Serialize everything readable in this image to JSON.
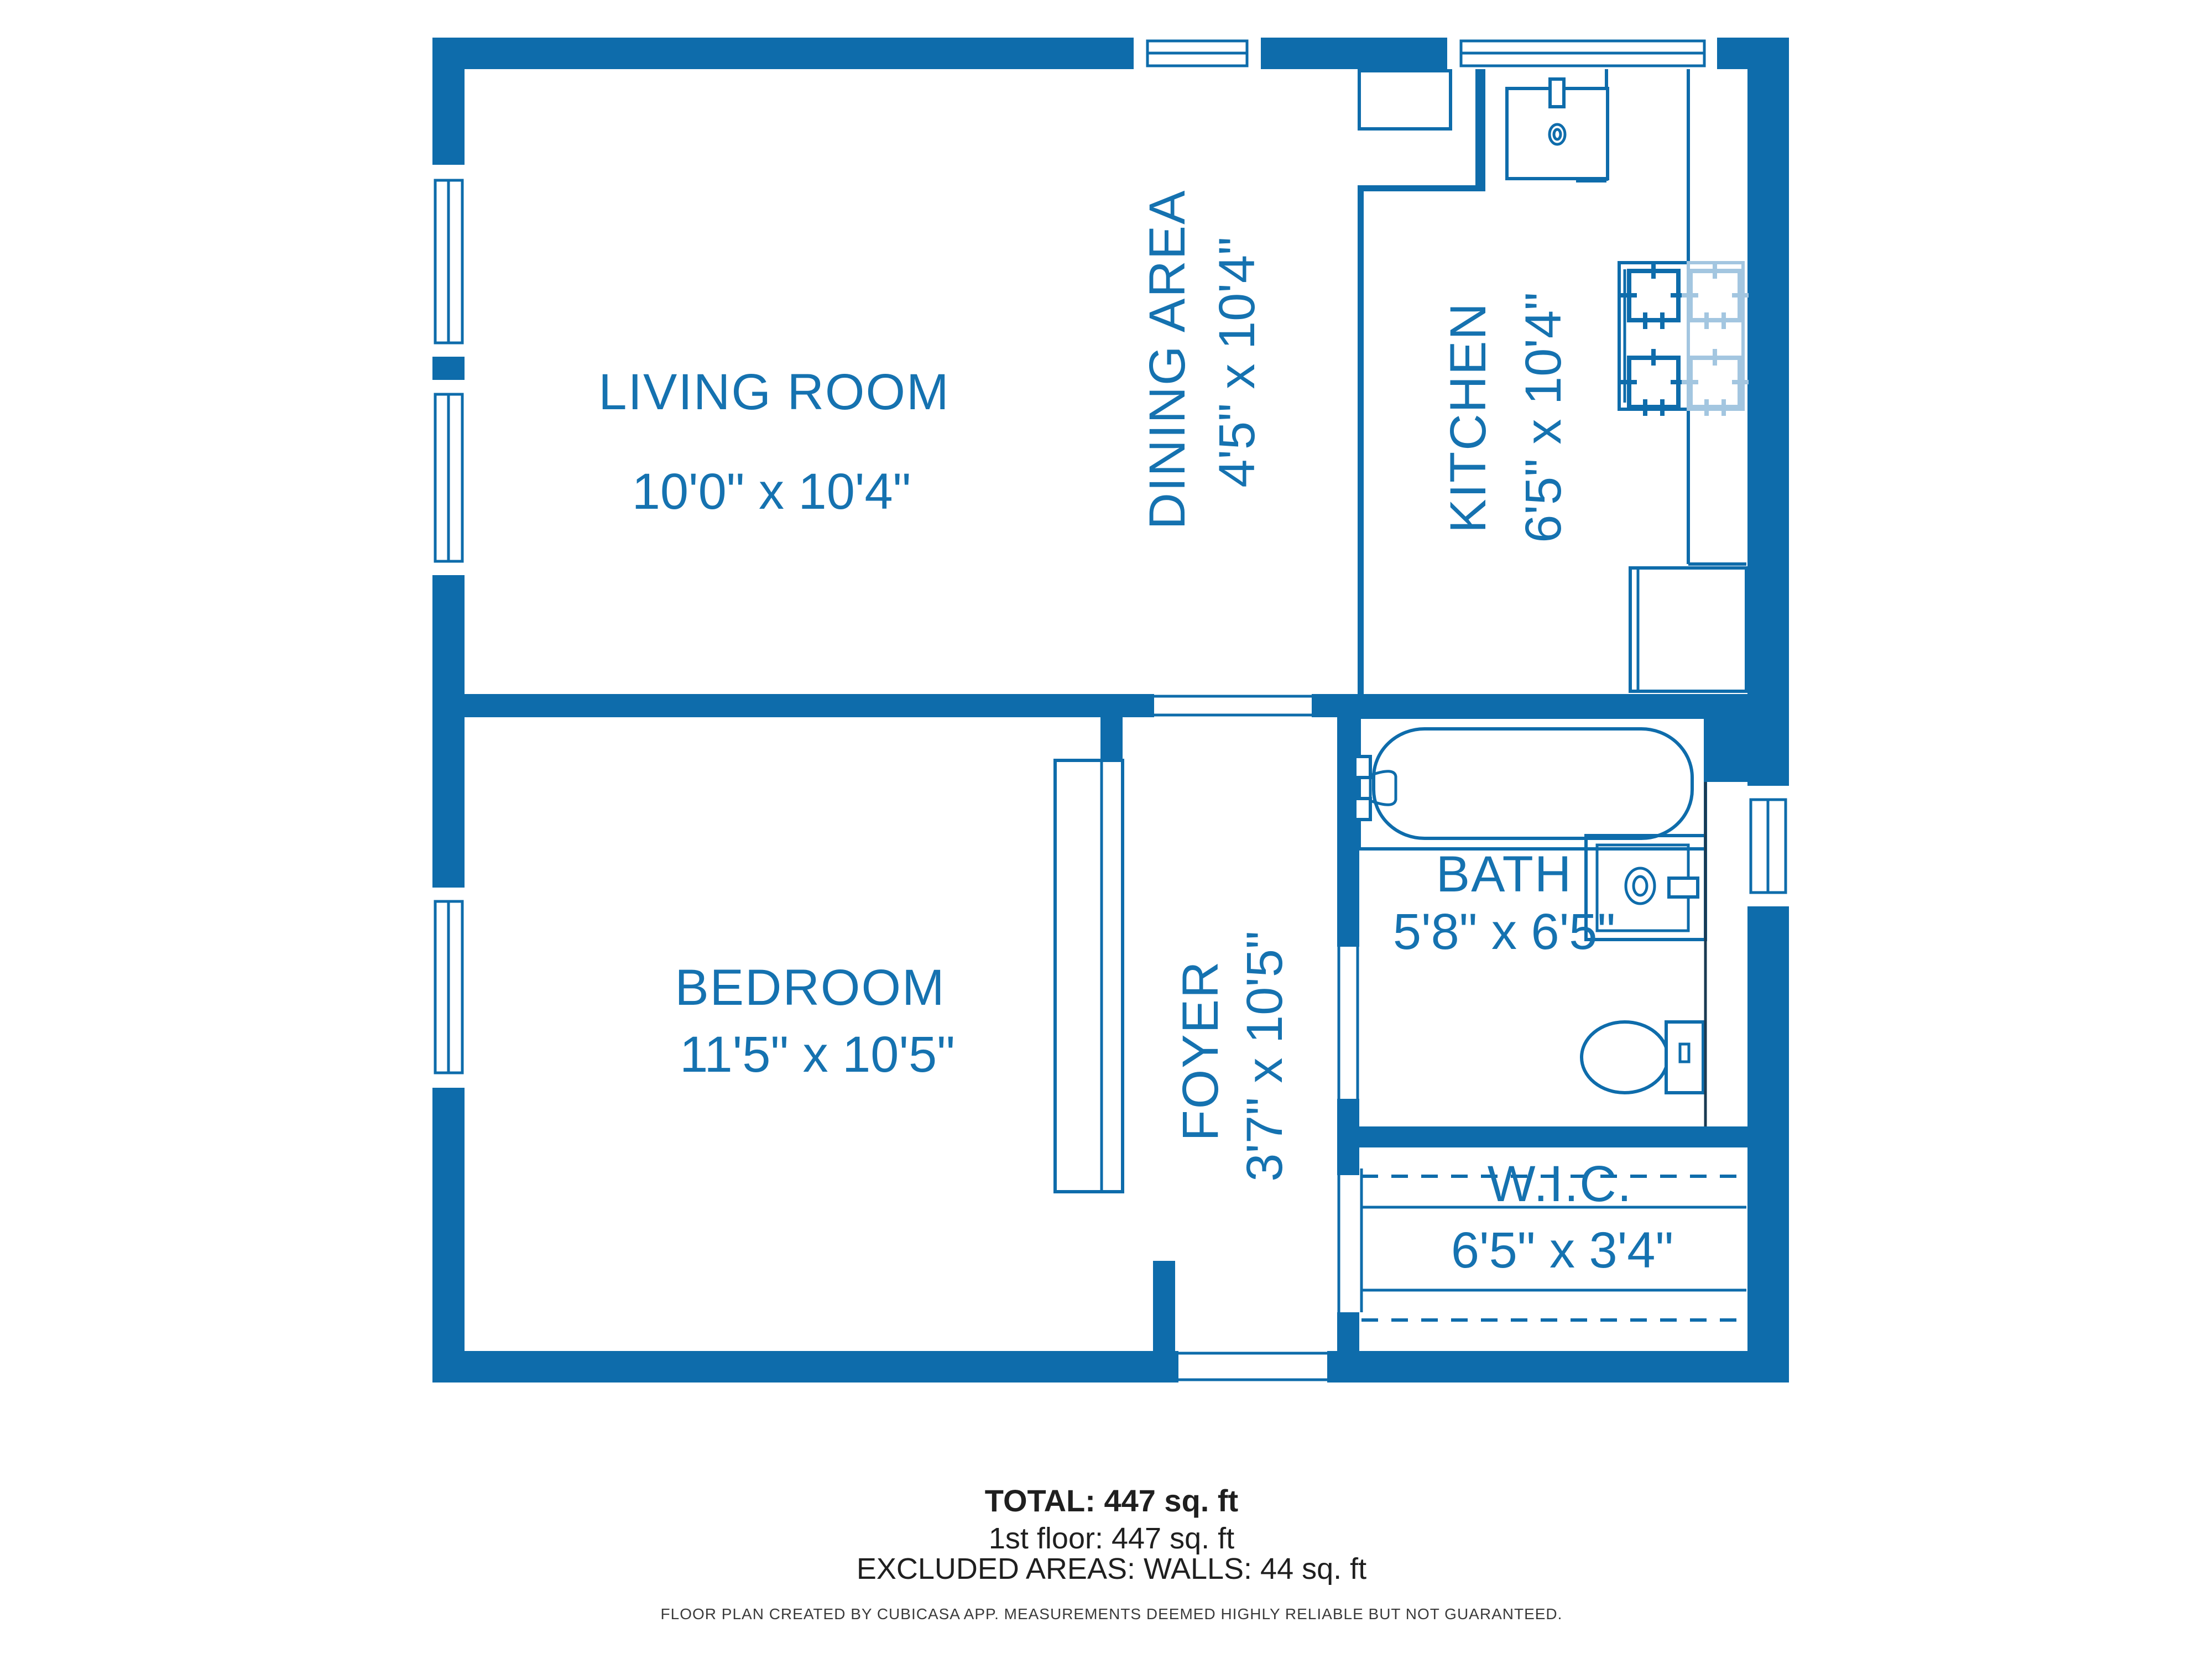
{
  "colors": {
    "wall_blue": "#0E6CAB",
    "light_blue": "#A3C6E0",
    "text_blue": "#1572B0",
    "summary_text": "#1F1F1F",
    "fineprint_text": "#3A3A3A",
    "background": "#FFFFFF"
  },
  "rooms": {
    "living": {
      "name": "LIVING ROOM",
      "dims": "10'0\" x 10'4\""
    },
    "dining": {
      "name": "DINING AREA",
      "dims": "4'5\" x 10'4\""
    },
    "kitchen": {
      "name": "KITCHEN",
      "dims": "6'5\" x 10'4\""
    },
    "bedroom": {
      "name": "BEDROOM",
      "dims": "11'5\" x 10'5\""
    },
    "foyer": {
      "name": "FOYER",
      "dims": "3'7\" x 10'5\""
    },
    "bath": {
      "name": "BATH",
      "dims": "5'8\" x 6'5\""
    },
    "wic": {
      "name": "W.I.C.",
      "dims": "6'5\" x 3'4\""
    }
  },
  "summary": {
    "total": "TOTAL: 447 sq. ft",
    "floor": "1st floor: 447 sq. ft",
    "excluded": "EXCLUDED AREAS: WALLS: 44 sq. ft"
  },
  "disclaimer": "FLOOR PLAN CREATED BY CUBICASA APP. MEASUREMENTS DEEMED HIGHLY RELIABLE BUT NOT GUARANTEED."
}
